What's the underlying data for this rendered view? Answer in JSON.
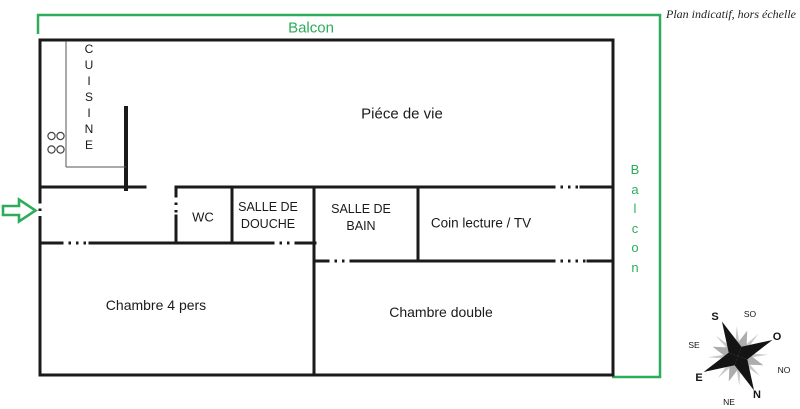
{
  "title_note": "Plan indicatif, hors échelle",
  "palette": {
    "green": "#2dac5a",
    "wall_black": "#1a1a1a",
    "thin_gray": "#555555",
    "compass_black": "#141414",
    "compass_gray": "#adadad",
    "compass_light": "#c9c9c9"
  },
  "balcony": {
    "top_label": "Balcon",
    "right_label": "Balcon"
  },
  "rooms": {
    "kitchen": {
      "label": "CUISINE",
      "icon": "stove-burners"
    },
    "living": {
      "label": "Piéce de vie"
    },
    "wc": {
      "label": "WC"
    },
    "shower": {
      "line1": "SALLE DE",
      "line2": "DOUCHE"
    },
    "bath": {
      "line1": "SALLE DE",
      "line2": "BAIN"
    },
    "reading": {
      "label": "Coin lecture / TV"
    },
    "bedroom_family": {
      "label": "Chambre 4 pers"
    },
    "bedroom_double": {
      "label": "Chambre double"
    }
  },
  "entrance": {
    "icon": "green-block-arrow-right"
  },
  "compass": {
    "n": "N",
    "s": "S",
    "e": "E",
    "o": "O",
    "ne": "NE",
    "no": "NO",
    "se": "SE",
    "so": "SO"
  }
}
